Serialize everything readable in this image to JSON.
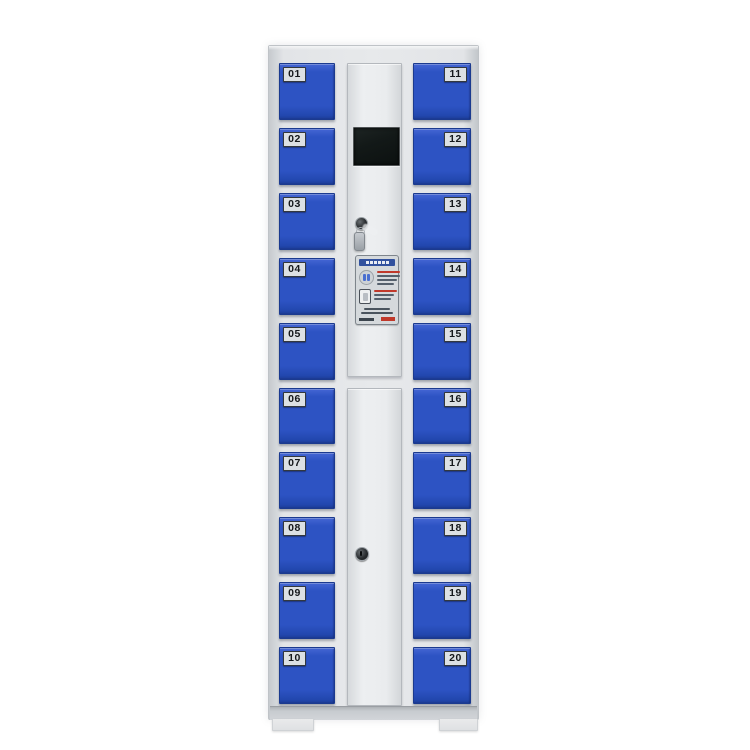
{
  "image": {
    "description": "Front view photo of a 20-compartment electronic storage locker cabinet on white background",
    "background": "#ffffff"
  },
  "cabinet": {
    "left_column_doors": [
      "01",
      "02",
      "03",
      "04",
      "05",
      "06",
      "07",
      "08",
      "09",
      "10"
    ],
    "right_column_doors": [
      "11",
      "12",
      "13",
      "14",
      "15",
      "16",
      "17",
      "18",
      "19",
      "20"
    ],
    "door_count": 20,
    "control_panel": {
      "screen": {
        "type": "lcd-display",
        "state": "off"
      },
      "upper_lock": {
        "icon": "key-lock-icon",
        "keys_hanging": true
      },
      "instruction_sticker": {
        "header_bar": "blue title bar (micro-text, illegible)",
        "icon_rows": [
          "card-reader-icon",
          "phone-icon"
        ],
        "accent_lines": "red micro-text lines (illegible)"
      },
      "lower_lock": {
        "icon": "keyhole-icon"
      }
    },
    "colors": {
      "door_blue": "#2d53c3",
      "door_blue_dark": "#1c3c96",
      "frame_light": "#e7e9eb",
      "frame_mid": "#c6cace",
      "plate_bg": "#dce0e3",
      "plate_text": "#15181b",
      "screen_black": "#131918",
      "sticker_header": "#31519e",
      "sticker_accent": "#c0392b",
      "base_gray": "#c7cbcf"
    }
  }
}
